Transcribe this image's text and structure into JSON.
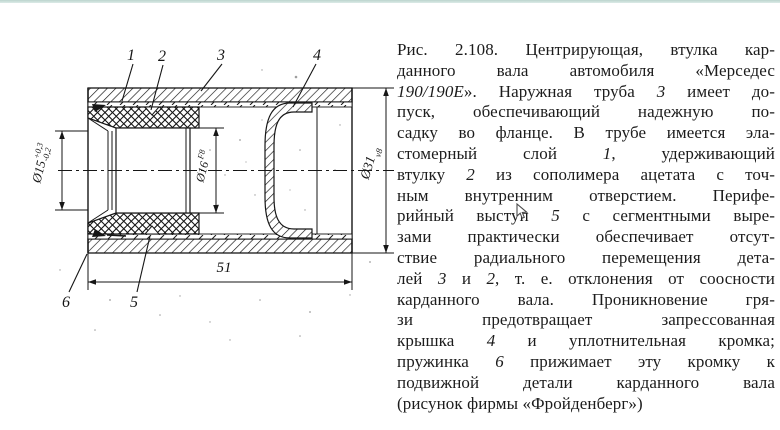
{
  "page": {
    "background": "#ffffff",
    "top_rule_color": "#c9dcd7",
    "ink_color": "#161616"
  },
  "figure": {
    "callouts": {
      "c1": "1",
      "c2": "2",
      "c3": "3",
      "c4": "4",
      "c5": "5",
      "c6": "6"
    },
    "dimensions": {
      "d15_main": "Ø15",
      "d15_upper": "+0,3",
      "d15_lower": "-0,2",
      "d16_main": "Ø16",
      "d16_class": "F8",
      "d31_main": "Ø31",
      "d31_class": "v8",
      "length": "51"
    }
  },
  "caption": {
    "lines": [
      [
        {
          "t": "Рис. 2.108. Центрирующая, втулка кар-",
          "i": false
        }
      ],
      [
        {
          "t": "данного вала автомобиля «Мерседес",
          "i": false
        }
      ],
      [
        {
          "t": "190/190E",
          "i": true
        },
        {
          "t": "». Наружная труба ",
          "i": false
        },
        {
          "t": "3",
          "i": true
        },
        {
          "t": " имеет до-",
          "i": false
        }
      ],
      [
        {
          "t": "пуск, обеспечивающий надежную по-",
          "i": false
        }
      ],
      [
        {
          "t": "садку во фланце. В трубе имеется эла-",
          "i": false
        }
      ],
      [
        {
          "t": "стомерный слой ",
          "i": false
        },
        {
          "t": "1",
          "i": true
        },
        {
          "t": ", удерживающий",
          "i": false
        }
      ],
      [
        {
          "t": "втулку ",
          "i": false
        },
        {
          "t": "2",
          "i": true
        },
        {
          "t": " из сополимера ацетата с точ-",
          "i": false
        }
      ],
      [
        {
          "t": "ным внутренним отверстием. Перифе-",
          "i": false
        }
      ],
      [
        {
          "t": "рийный выступ ",
          "i": false
        },
        {
          "t": "5",
          "i": true
        },
        {
          "t": " с сегментными выре-",
          "i": false
        }
      ],
      [
        {
          "t": "зами практически обеспечивает отсут-",
          "i": false
        }
      ],
      [
        {
          "t": "ствие радиального перемещения дета-",
          "i": false
        }
      ],
      [
        {
          "t": "лей ",
          "i": false
        },
        {
          "t": "3",
          "i": true
        },
        {
          "t": " и ",
          "i": false
        },
        {
          "t": "2",
          "i": true
        },
        {
          "t": ", т. е. отклонения от соосности",
          "i": false
        }
      ],
      [
        {
          "t": "карданного вала. Проникновение гря-",
          "i": false
        }
      ],
      [
        {
          "t": "зи предотвращает запрессованная",
          "i": false
        }
      ],
      [
        {
          "t": "крышка ",
          "i": false
        },
        {
          "t": "4",
          "i": true
        },
        {
          "t": " и уплотнительная кромка;",
          "i": false
        }
      ],
      [
        {
          "t": "пружинка ",
          "i": false
        },
        {
          "t": "6",
          "i": true
        },
        {
          "t": " прижимает эту кромку к",
          "i": false
        }
      ],
      [
        {
          "t": "подвижной детали карданного вала",
          "i": false
        }
      ],
      [
        {
          "t": "(рисунок фирмы «Фройденберг»)",
          "i": false
        }
      ]
    ]
  }
}
